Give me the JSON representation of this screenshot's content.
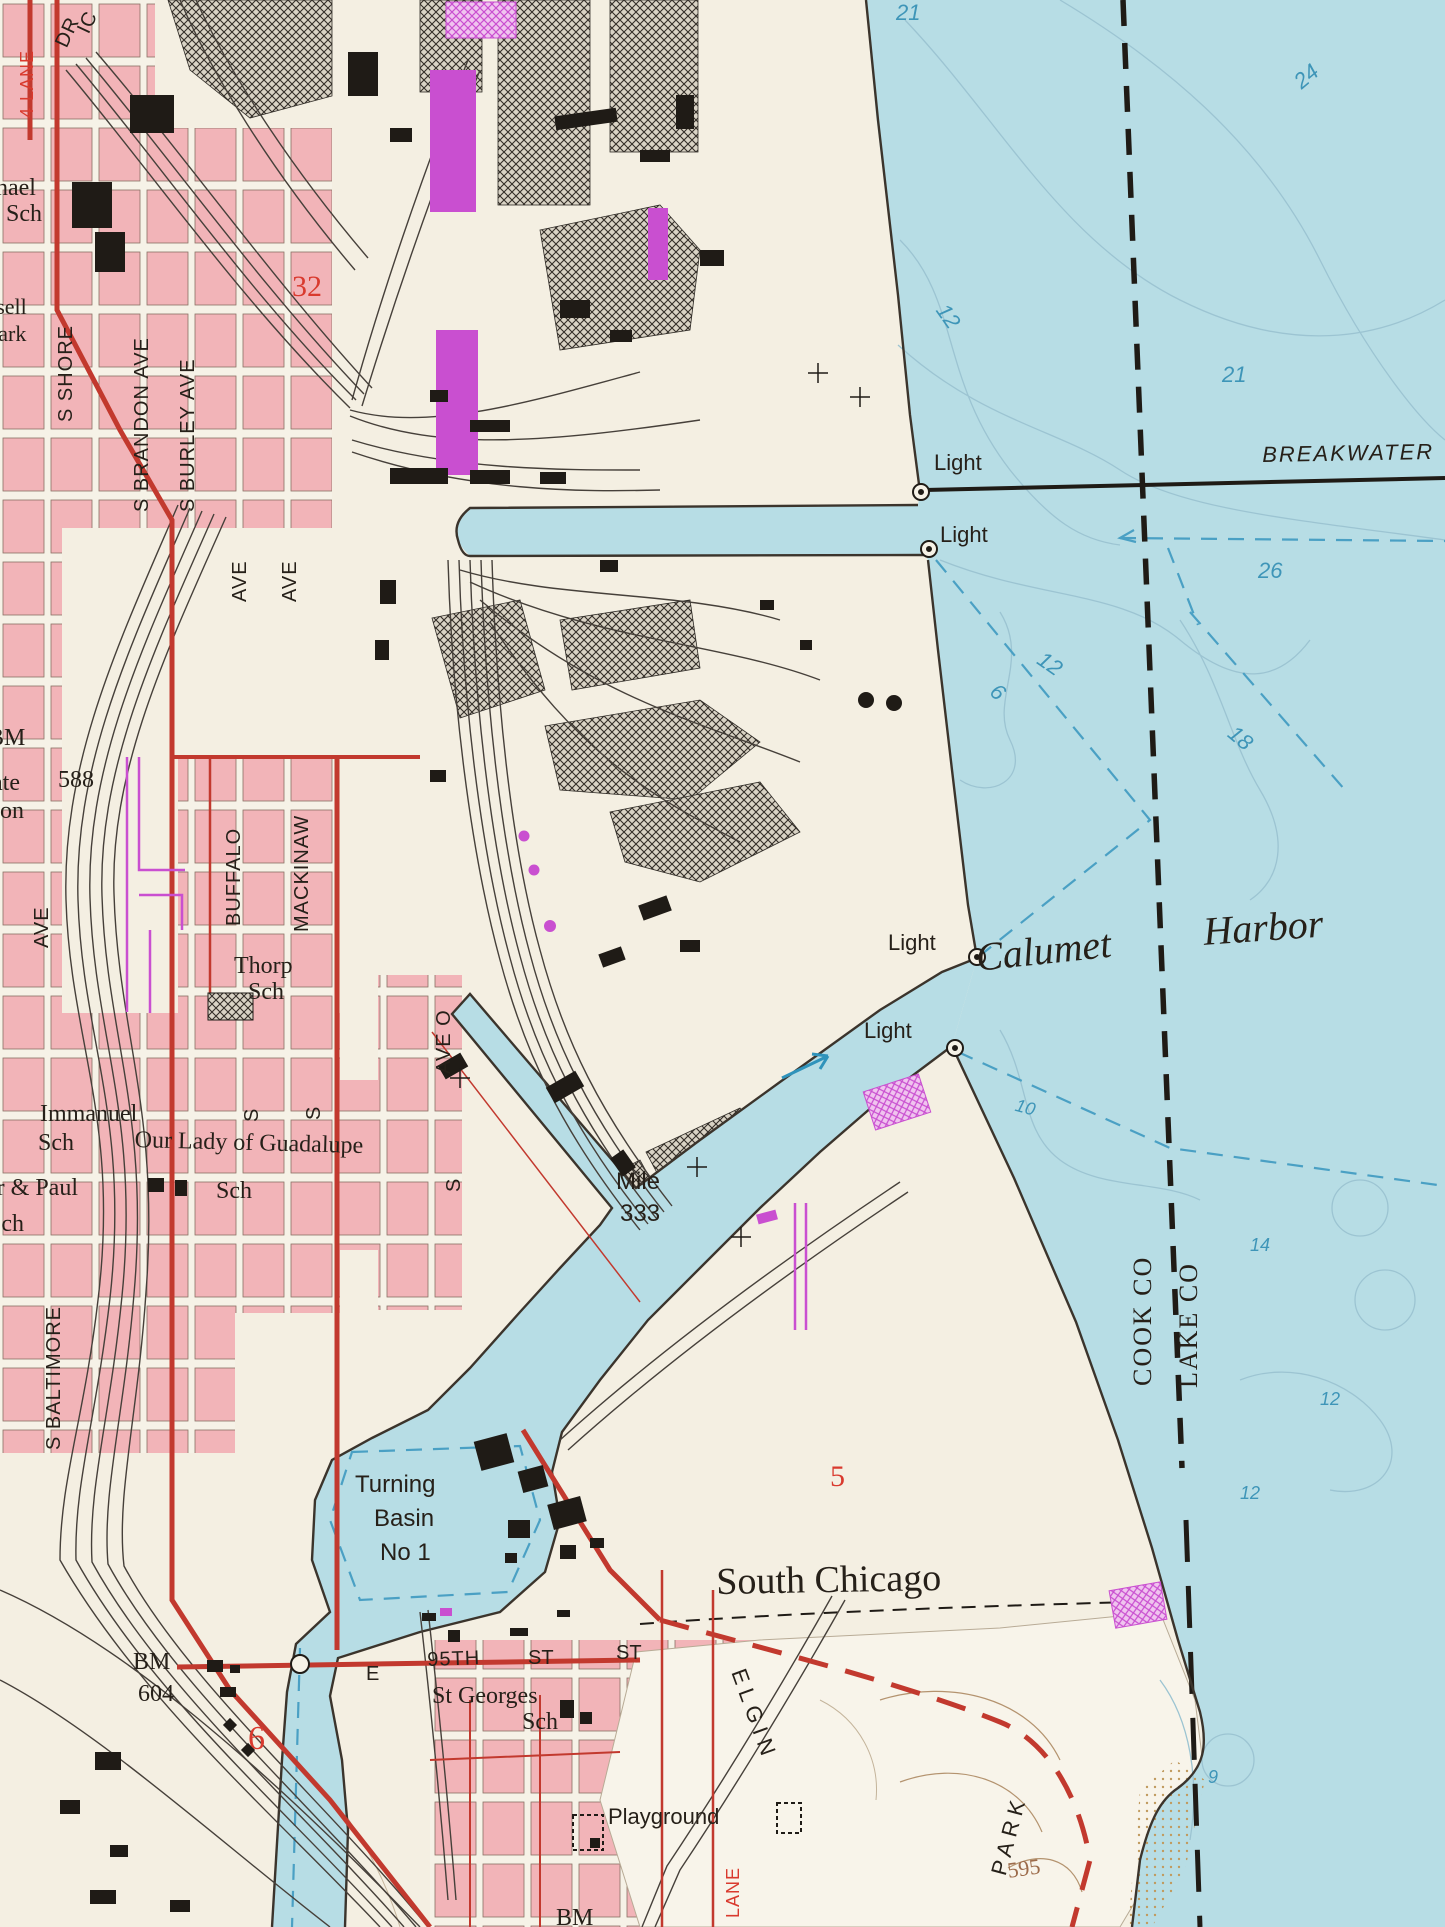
{
  "palette": {
    "land": "#f4efe2",
    "park_land": "#f8f4ea",
    "water": "#b7dde5",
    "pink_urban": "#f2b4b8",
    "street_white": "#f6f2e7",
    "ink": "#262019",
    "road_red": "#c2392e",
    "redtxt": "#d93a2e",
    "depth_blue_text": "#3e95b8",
    "channel_dash_blue": "#4aa0c4",
    "contour_blue": "#9cc4d2",
    "contour_brown": "#b4936f",
    "brown": "#9c6b4a",
    "magenta": "#c94fd0",
    "rail": "#46403a",
    "shore": "#3b342c",
    "hatch": "#332e28"
  },
  "map": {
    "water_body_labels": [
      "Calumet",
      "Harbor",
      "BREAKWATER"
    ],
    "navigation_labels": [
      "Light",
      "Mile 333",
      "Turning Basin No 1"
    ],
    "boundary_labels": [
      "COOK CO",
      "LAKE CO"
    ],
    "depth_soundings": [
      21,
      24,
      12,
      21,
      26,
      12,
      6,
      18,
      10,
      14,
      12,
      12,
      9
    ],
    "spot_elevations": [
      "588",
      "604",
      "595"
    ],
    "labels": [
      {
        "id": "four-lane",
        "kind": "street",
        "text": "4 LANE",
        "x": 18,
        "y": 118,
        "rot": -90,
        "cls": "sans sz18 red ls1"
      },
      {
        "id": "dr",
        "kind": "street",
        "text": "DR",
        "x": 52,
        "y": 42,
        "rot": -65,
        "cls": "sans sz20 ls1"
      },
      {
        "id": "ic",
        "kind": "street",
        "text": "IC",
        "x": 74,
        "y": 28,
        "rot": -65,
        "cls": "sans sz20 ls1"
      },
      {
        "id": "s-shore",
        "kind": "street",
        "text": "S SHORE",
        "x": 56,
        "y": 422,
        "rot": -90,
        "cls": "sans sz20 ls1"
      },
      {
        "id": "s-brandon-ave",
        "kind": "street",
        "text": "S BRANDON AVE",
        "x": 132,
        "y": 512,
        "rot": -90,
        "cls": "sans sz20 ls1"
      },
      {
        "id": "s-burley-ave",
        "kind": "street",
        "text": "S BURLEY AVE",
        "x": 178,
        "y": 512,
        "rot": -90,
        "cls": "sans sz20 ls1"
      },
      {
        "id": "ave-1",
        "kind": "street",
        "text": "AVE",
        "x": 230,
        "y": 602,
        "rot": -90,
        "cls": "sans sz20 ls1"
      },
      {
        "id": "ave-2",
        "kind": "street",
        "text": "AVE",
        "x": 280,
        "y": 602,
        "rot": -90,
        "cls": "sans sz20 ls1"
      },
      {
        "id": "ave-3",
        "kind": "street",
        "text": "AVE",
        "x": 32,
        "y": 948,
        "rot": -90,
        "cls": "sans sz20 ls1"
      },
      {
        "id": "buffalo",
        "kind": "street",
        "text": "BUFFALO",
        "x": 224,
        "y": 926,
        "rot": -90,
        "cls": "sans sz20 ls1"
      },
      {
        "id": "mackinaw",
        "kind": "street",
        "text": "MACKINAW",
        "x": 292,
        "y": 932,
        "rot": -90,
        "cls": "sans sz20 ls1"
      },
      {
        "id": "ave-o",
        "kind": "street",
        "text": "AVE O",
        "x": 434,
        "y": 1074,
        "rot": -90,
        "cls": "sans sz20 ls1"
      },
      {
        "id": "s-1",
        "kind": "street",
        "text": "S",
        "x": 444,
        "y": 1192,
        "rot": -90,
        "cls": "sans sz20"
      },
      {
        "id": "s-2",
        "kind": "street",
        "text": "S",
        "x": 242,
        "y": 1122,
        "rot": -90,
        "cls": "sans sz20"
      },
      {
        "id": "s-3",
        "kind": "street",
        "text": "S",
        "x": 304,
        "y": 1120,
        "rot": -90,
        "cls": "sans sz20"
      },
      {
        "id": "s-baltimore",
        "kind": "street",
        "text": "S BALTIMORE",
        "x": 44,
        "y": 1450,
        "rot": -90,
        "cls": "sans sz20 ls1"
      },
      {
        "id": "e-95th-e",
        "kind": "street",
        "text": "E",
        "x": 366,
        "y": 1664,
        "rot": 0,
        "cls": "sans sz20"
      },
      {
        "id": "e-95th",
        "kind": "street",
        "text": "95TH",
        "x": 427,
        "y": 1650,
        "rot": -2,
        "cls": "sans sz20 ls1"
      },
      {
        "id": "e-95th-st",
        "kind": "street",
        "text": "ST",
        "x": 528,
        "y": 1648,
        "rot": 0,
        "cls": "sans sz20"
      },
      {
        "id": "st-2",
        "kind": "street",
        "text": "ST",
        "x": 616,
        "y": 1643,
        "rot": 0,
        "cls": "sans sz20"
      },
      {
        "id": "elgin",
        "kind": "street",
        "text": "ELGIN",
        "x": 748,
        "y": 1666,
        "rot": 70,
        "cls": "sans sz22 ls6"
      },
      {
        "id": "lane-red",
        "kind": "street",
        "text": "LANE",
        "x": 724,
        "y": 1918,
        "rot": -90,
        "cls": "sans sz18 red ls1"
      },
      {
        "id": "park",
        "kind": "place",
        "text": "PARK",
        "x": 988,
        "y": 1872,
        "rot": -75,
        "cls": "sans sz22 ls6"
      },
      {
        "id": "michael-sch-1",
        "kind": "place",
        "text": "nael",
        "x": -4,
        "y": 176,
        "rot": 0,
        "cls": "serif sz24"
      },
      {
        "id": "michael-sch-2",
        "kind": "place",
        "text": "Sch",
        "x": 6,
        "y": 202,
        "rot": 0,
        "cls": "serif sz24"
      },
      {
        "id": "russell",
        "kind": "place",
        "text": "Russell",
        "x": -38,
        "y": 296,
        "rot": 0,
        "cls": "serif sz22"
      },
      {
        "id": "russell-park",
        "kind": "place",
        "text": "Park",
        "x": -14,
        "y": 323,
        "rot": 0,
        "cls": "serif sz22"
      },
      {
        "id": "bm-588-bm",
        "kind": "control",
        "text": "BM",
        "x": -12,
        "y": 726,
        "rot": 0,
        "cls": "serif sz24"
      },
      {
        "id": "bm-588",
        "kind": "control",
        "text": "588",
        "x": 58,
        "y": 768,
        "rot": 0,
        "cls": "serif sz24"
      },
      {
        "id": "ate",
        "kind": "place",
        "text": "ate",
        "x": -8,
        "y": 771,
        "rot": 0,
        "cls": "serif sz24"
      },
      {
        "id": "on",
        "kind": "place",
        "text": "on",
        "x": 0,
        "y": 799,
        "rot": 0,
        "cls": "serif sz24"
      },
      {
        "id": "thorp",
        "kind": "place",
        "text": "Thorp",
        "x": 234,
        "y": 954,
        "rot": 0,
        "cls": "serif sz24"
      },
      {
        "id": "thorp-sch",
        "kind": "place",
        "text": "Sch",
        "x": 248,
        "y": 980,
        "rot": 0,
        "cls": "serif sz24"
      },
      {
        "id": "immanuel",
        "kind": "place",
        "text": "Immanuel",
        "x": 40,
        "y": 1102,
        "rot": 0,
        "cls": "serif sz24"
      },
      {
        "id": "immanuel-sch",
        "kind": "place",
        "text": "Sch",
        "x": 38,
        "y": 1131,
        "rot": 0,
        "cls": "serif sz24"
      },
      {
        "id": "guadalupe",
        "kind": "place",
        "text": "Our Lady of Guadalupe",
        "x": 135,
        "y": 1128,
        "rot": 1.5,
        "cls": "serif sz24"
      },
      {
        "id": "guadalupe-sch",
        "kind": "place",
        "text": "Sch",
        "x": 216,
        "y": 1179,
        "rot": 0,
        "cls": "serif sz24"
      },
      {
        "id": "peter-paul",
        "kind": "place",
        "text": "er & Paul",
        "x": -14,
        "y": 1176,
        "rot": 0,
        "cls": "serif sz24"
      },
      {
        "id": "peter-paul-sch",
        "kind": "place",
        "text": "Sch",
        "x": -12,
        "y": 1212,
        "rot": 0,
        "cls": "serif sz24"
      },
      {
        "id": "st-georges",
        "kind": "place",
        "text": "St Georges",
        "x": 432,
        "y": 1684,
        "rot": 0,
        "cls": "serif sz24"
      },
      {
        "id": "st-georges-sch",
        "kind": "place",
        "text": "Sch",
        "x": 522,
        "y": 1710,
        "rot": 0,
        "cls": "serif sz24"
      },
      {
        "id": "bm-604-bm",
        "kind": "control",
        "text": "BM",
        "x": 133,
        "y": 1650,
        "rot": 0,
        "cls": "serif sz24"
      },
      {
        "id": "bm-604",
        "kind": "control",
        "text": "604",
        "x": 138,
        "y": 1682,
        "rot": 0,
        "cls": "serif sz24"
      },
      {
        "id": "bm-bottom",
        "kind": "control",
        "text": "BM",
        "x": 556,
        "y": 1906,
        "rot": 0,
        "cls": "serif sz24"
      },
      {
        "id": "south-chicago",
        "kind": "place",
        "text": "South Chicago",
        "x": 716,
        "y": 1563,
        "rot": -1,
        "cls": "serif sz38"
      },
      {
        "id": "playground",
        "kind": "place",
        "text": "Playground",
        "x": 608,
        "y": 1806,
        "rot": 0,
        "cls": "sans sz22"
      },
      {
        "id": "turning-1",
        "kind": "navigation",
        "text": "Turning",
        "x": 355,
        "y": 1473,
        "rot": 0,
        "cls": "sans sz24"
      },
      {
        "id": "turning-2",
        "kind": "navigation",
        "text": "Basin",
        "x": 374,
        "y": 1507,
        "rot": 0,
        "cls": "sans sz24"
      },
      {
        "id": "turning-3",
        "kind": "navigation",
        "text": "No 1",
        "x": 380,
        "y": 1541,
        "rot": 0,
        "cls": "sans sz24"
      },
      {
        "id": "mile-1",
        "kind": "navigation",
        "text": "Mile",
        "x": 616,
        "y": 1170,
        "rot": 0,
        "cls": "sans sz24"
      },
      {
        "id": "mile-2",
        "kind": "navigation",
        "text": "333",
        "x": 620,
        "y": 1202,
        "rot": 0,
        "cls": "sans sz24"
      },
      {
        "id": "light-1",
        "kind": "navigation",
        "text": "Light",
        "x": 934,
        "y": 452,
        "rot": 0,
        "cls": "sans sz22"
      },
      {
        "id": "light-2",
        "kind": "navigation",
        "text": "Light",
        "x": 940,
        "y": 524,
        "rot": 0,
        "cls": "sans sz22"
      },
      {
        "id": "light-3",
        "kind": "navigation",
        "text": "Light",
        "x": 888,
        "y": 932,
        "rot": 0,
        "cls": "sans sz22"
      },
      {
        "id": "light-4",
        "kind": "navigation",
        "text": "Light",
        "x": 864,
        "y": 1020,
        "rot": 0,
        "cls": "sans sz22"
      },
      {
        "id": "breakwater",
        "kind": "hydro",
        "text": "BREAKWATER",
        "x": 1262,
        "y": 444,
        "rot": -1,
        "cls": "sans sz22 it ls2"
      },
      {
        "id": "calumet",
        "kind": "hydro",
        "text": "Calumet",
        "x": 974,
        "y": 938,
        "rot": -6,
        "cls": "serif sz40 it"
      },
      {
        "id": "harbor",
        "kind": "hydro",
        "text": "Harbor",
        "x": 1202,
        "y": 912,
        "rot": -4,
        "cls": "serif sz40 it"
      },
      {
        "id": "cook-co",
        "kind": "boundary",
        "text": "COOK CO",
        "x": 1130,
        "y": 1386,
        "rot": -90,
        "cls": "serif sz26 county"
      },
      {
        "id": "lake-co",
        "kind": "boundary",
        "text": "LAKE CO",
        "x": 1176,
        "y": 1388,
        "rot": -90,
        "cls": "serif sz26 county"
      },
      {
        "id": "elev-595",
        "kind": "control",
        "text": "595",
        "x": 1006,
        "y": 1860,
        "rot": -8,
        "cls": "serif sz22 brown"
      },
      {
        "id": "sec-32",
        "kind": "section",
        "text": "32",
        "x": 292,
        "y": 272,
        "rot": 0,
        "cls": "serif sz30 red"
      },
      {
        "id": "sec-5",
        "kind": "section",
        "text": "5",
        "x": 830,
        "y": 1462,
        "rot": 0,
        "cls": "serif sz30 red"
      },
      {
        "id": "sec-6",
        "kind": "section",
        "text": "6",
        "x": 248,
        "y": 1722,
        "rot": 0,
        "cls": "serif sz34 red"
      },
      {
        "id": "depth-21a",
        "kind": "depth",
        "text": "21",
        "x": 896,
        "y": 2,
        "rot": 0,
        "cls": "sans sz22 it blue"
      },
      {
        "id": "depth-24",
        "kind": "depth",
        "text": "24",
        "x": 1290,
        "y": 76,
        "rot": -40,
        "cls": "sans sz22 it blue"
      },
      {
        "id": "depth-12a",
        "kind": "depth",
        "text": "12",
        "x": 950,
        "y": 300,
        "rot": 55,
        "cls": "sans sz22 it blue"
      },
      {
        "id": "depth-21b",
        "kind": "depth",
        "text": "21",
        "x": 1222,
        "y": 364,
        "rot": 0,
        "cls": "sans sz22 it blue"
      },
      {
        "id": "depth-26",
        "kind": "depth",
        "text": "26",
        "x": 1258,
        "y": 560,
        "rot": 0,
        "cls": "sans sz22 it blue"
      },
      {
        "id": "depth-12b",
        "kind": "depth",
        "text": "12",
        "x": 1046,
        "y": 648,
        "rot": 35,
        "cls": "sans sz22 it blue"
      },
      {
        "id": "depth-6",
        "kind": "depth",
        "text": "6",
        "x": 1000,
        "y": 680,
        "rot": 40,
        "cls": "sans sz22 it blue"
      },
      {
        "id": "depth-18",
        "kind": "depth",
        "text": "18",
        "x": 1238,
        "y": 722,
        "rot": 40,
        "cls": "sans sz22 it blue"
      },
      {
        "id": "depth-10",
        "kind": "depth",
        "text": "10",
        "x": 1018,
        "y": 1096,
        "rot": 15,
        "cls": "sans sz18 it blue"
      },
      {
        "id": "depth-14",
        "kind": "depth",
        "text": "14",
        "x": 1250,
        "y": 1236,
        "rot": 0,
        "cls": "sans sz18 it blue"
      },
      {
        "id": "depth-12c",
        "kind": "depth",
        "text": "12",
        "x": 1320,
        "y": 1390,
        "rot": 0,
        "cls": "sans sz18 it blue"
      },
      {
        "id": "depth-12d",
        "kind": "depth",
        "text": "12",
        "x": 1240,
        "y": 1484,
        "rot": 0,
        "cls": "sans sz18 it blue"
      },
      {
        "id": "depth-9",
        "kind": "depth",
        "text": "9",
        "x": 1208,
        "y": 1768,
        "rot": 0,
        "cls": "sans sz18 it blue"
      }
    ]
  }
}
